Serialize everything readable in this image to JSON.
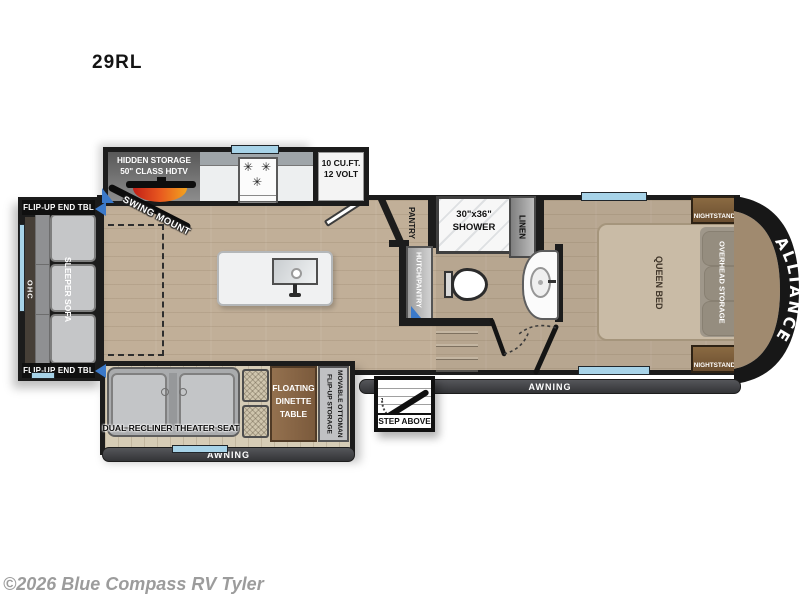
{
  "page": {
    "model": "29RL",
    "watermark": "©2026 Blue Compass RV Tyler"
  },
  "colors": {
    "wall": "#1c1c1c",
    "window_blue": "#a7d3e8",
    "wood_main": "#c1af98",
    "wood_rear_slide": "#7a6148",
    "wood_door_slide": "#d6ccb6",
    "awning_bar": "#434446",
    "nightstand_brown": "#7b5b38",
    "table_brown": "#8a674a",
    "swing_arc_red": "#d92b1c",
    "slide_arrow_blue": "#3b79c9"
  },
  "icons": {
    "burner": "✳"
  },
  "rear_slide": {
    "end_table_top": "FLIP-UP END TBL",
    "end_table_bottom": "FLIP-UP END TBL",
    "ohc": "OHC",
    "sofa": "SLEEPER SOFA"
  },
  "kitchen": {
    "hidden_storage": "HIDDEN STORAGE\n50\" CLASS HDTV",
    "swing_mount": "SWING MOUNT",
    "fridge": "10 CU.FT.\n12 VOLT"
  },
  "bath": {
    "pantry": "PANTRY",
    "hutch": "HUTCH/PANTRY",
    "shower": "30\"x36\"\nSHOWER",
    "linen": "LINEN"
  },
  "bedroom": {
    "bed": "QUEEN BED",
    "overhead": "OVERHEAD STORAGE",
    "nightstand_top": "NIGHTSTAND",
    "nightstand_bottom": "NIGHTSTAND",
    "brand": "ALLIANCE"
  },
  "door_slide": {
    "theater": "DUAL RECLINER THEATER SEAT",
    "dinette": "FLOATING\nDINETTE\nTABLE",
    "ottoman": "MOVABLE OTTOMAN\nFLIP-UP STORAGE"
  },
  "exterior": {
    "awning_left": "AWNING",
    "awning_right": "AWNING",
    "step": "STEP ABOVE"
  }
}
